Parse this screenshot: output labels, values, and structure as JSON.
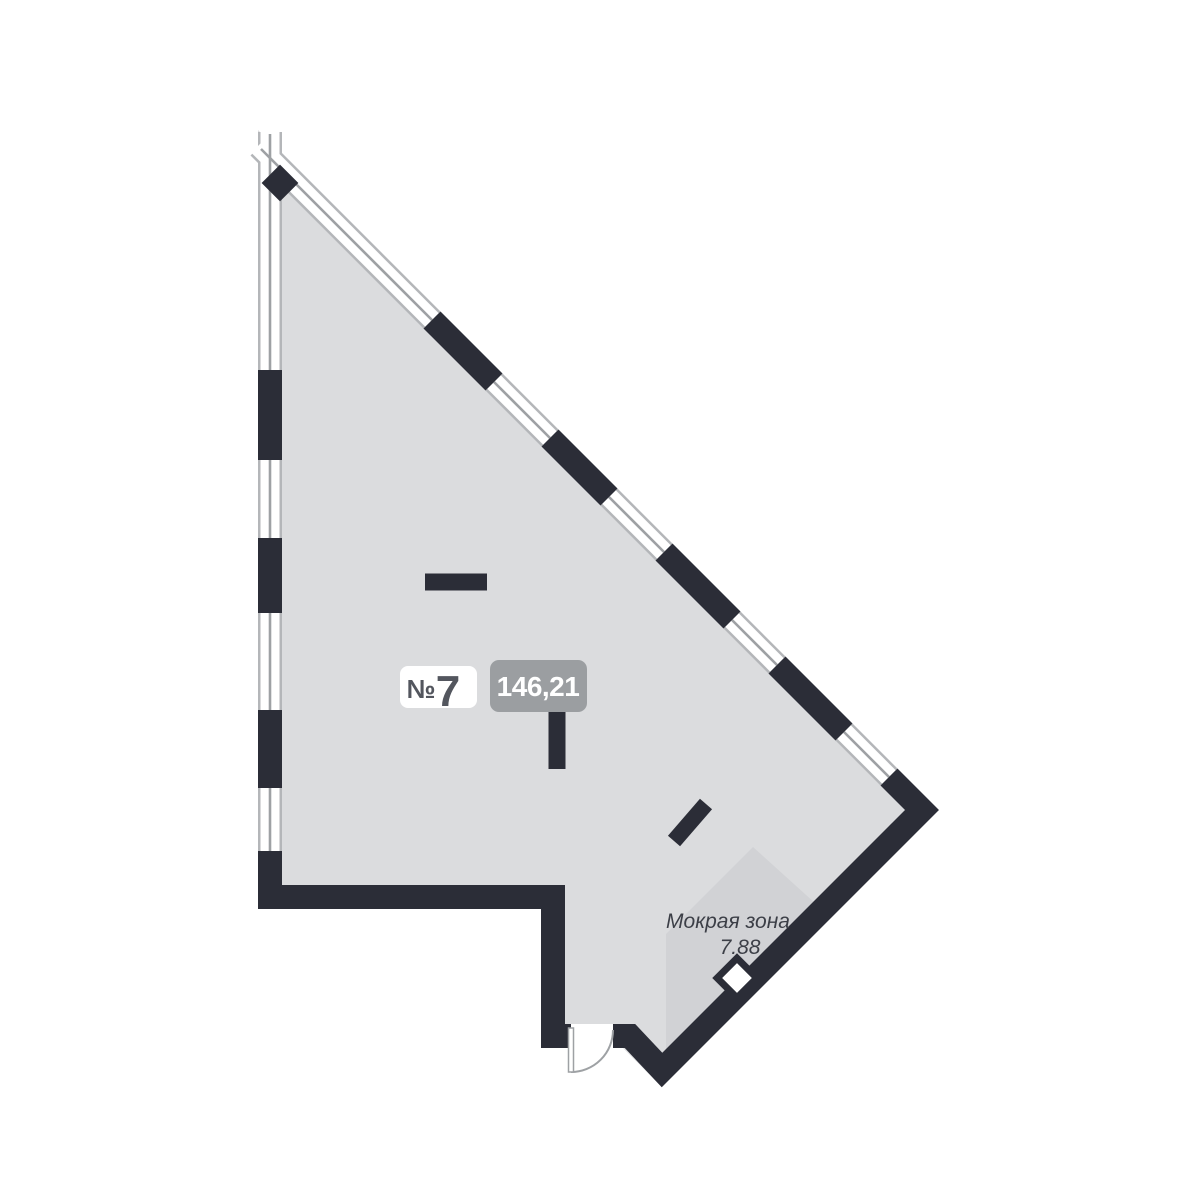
{
  "unit_badge": {
    "prefix": "№",
    "number": "7"
  },
  "area_badge": {
    "value": "146,21"
  },
  "wet_zone": {
    "label": "Мокрая зона",
    "area": "7.88"
  },
  "colors": {
    "wall": "#2b2d37",
    "floor": "#dbdcde",
    "wet_zone_fill": "#d1d2d5",
    "window_frame": "#b4b6b9",
    "glass_line": "#9ea1a4",
    "area_badge_bg": "#9b9ea1",
    "unit_badge_bg": "#ffffff",
    "unit_badge_text": "#53565e",
    "door_arc": "#9ea1a4"
  },
  "icons": {
    "corner_marker": "filled-diamond",
    "wet_zone_marker": "outlined-diamond"
  }
}
